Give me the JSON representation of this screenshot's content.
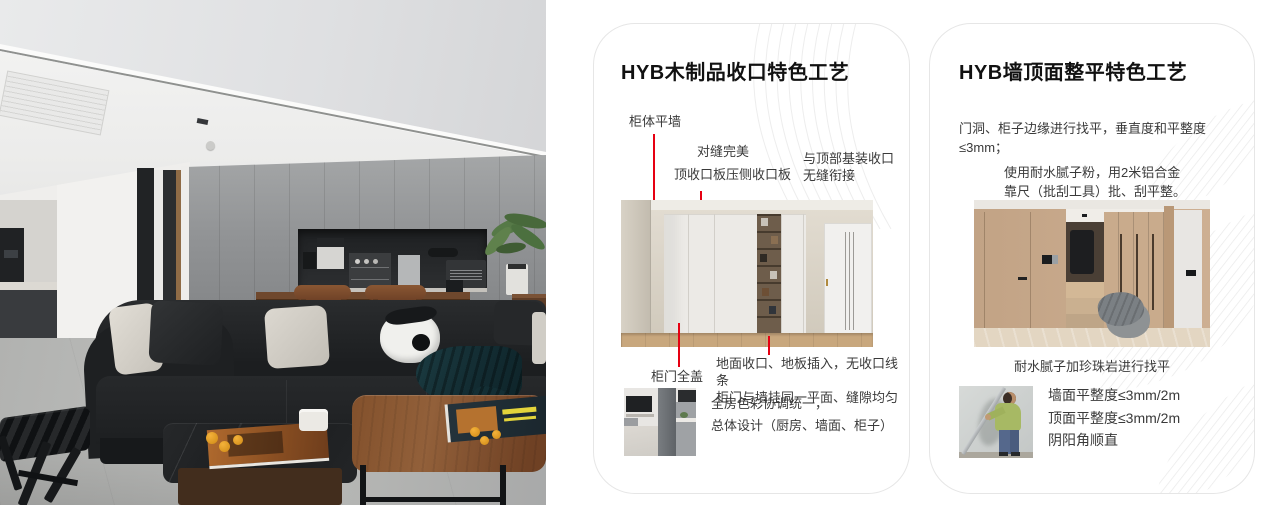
{
  "colors": {
    "accent_red": "#e60012",
    "card_border": "#e6e6e6",
    "pattern_gray": "#ebebeb"
  },
  "cards": [
    {
      "title": "HYB木制品收口特色工艺",
      "ann_cabinet_wall": "柜体平墙",
      "ann_seam": "对缝完美",
      "ann_top_panel": "顶收口板压侧收口板",
      "ann_ceiling_joint": "与顶部基装收口\n无缝衔接",
      "ann_door_cover": "柜门全盖",
      "note_floor": "地面收口、地板插入，无收口线条\n柜门与墙挂同一平面、缝隙均匀",
      "note_color": "全房色彩协调统一，\n总体设计（厨房、墙面、柜子）"
    },
    {
      "title": "HYB墙顶面整平特色工艺",
      "para_leveling": "门洞、柜子边缘进行找平，垂直度和平整度≤3mm；",
      "para_putty": "使用耐水腻子粉，用2米铝合金\n靠尺（批刮工具）批、刮平整。",
      "caption": "耐水腻子加珍珠岩进行找平",
      "bullets": [
        "墙面平整度≤3mm/2m",
        "顶面平整度≤3mm/2m",
        "阴阳角顺直"
      ]
    }
  ]
}
